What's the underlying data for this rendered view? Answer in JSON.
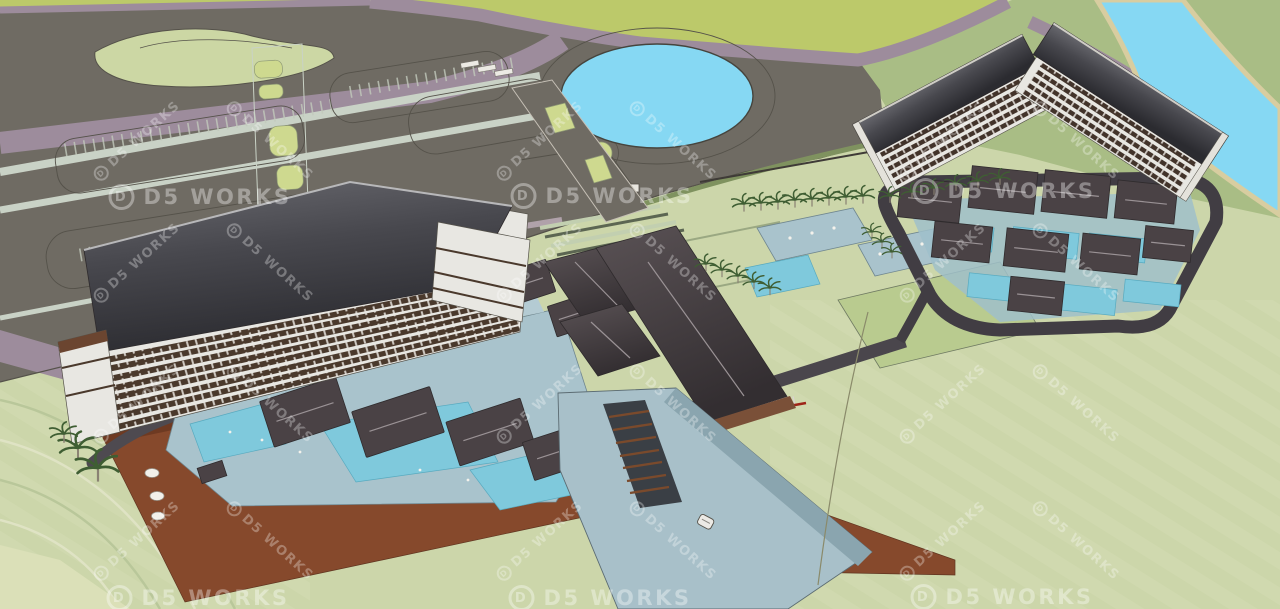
{
  "scene": {
    "title": "Aerial 3D massing render of a beachfront resort",
    "style": "sketchup-model-render",
    "features": [
      "parking lots",
      "circular pond",
      "left hotel slab",
      "right hotel L-block",
      "villa clusters with pools",
      "central clubhouse",
      "garden pools with palms",
      "river",
      "beach boardwalk",
      "pier deck with stairs",
      "roundabout"
    ]
  },
  "watermark": {
    "text": "D5 WORKS",
    "logo_letter": "D",
    "horizontal": [
      {
        "x": 200,
        "y": 197
      },
      {
        "x": 602,
        "y": 196
      },
      {
        "x": 1004,
        "y": 191
      },
      {
        "x": 198,
        "y": 598
      },
      {
        "x": 600,
        "y": 598
      },
      {
        "x": 1002,
        "y": 597
      }
    ],
    "diagonal": [
      {
        "x": 137,
        "y": 141,
        "dir": "up"
      },
      {
        "x": 270,
        "y": 141,
        "dir": "down"
      },
      {
        "x": 540,
        "y": 141,
        "dir": "up"
      },
      {
        "x": 673,
        "y": 141,
        "dir": "down"
      },
      {
        "x": 943,
        "y": 141,
        "dir": "up"
      },
      {
        "x": 1076,
        "y": 141,
        "dir": "down"
      },
      {
        "x": 137,
        "y": 263,
        "dir": "up"
      },
      {
        "x": 270,
        "y": 263,
        "dir": "down"
      },
      {
        "x": 540,
        "y": 263,
        "dir": "up"
      },
      {
        "x": 673,
        "y": 263,
        "dir": "down"
      },
      {
        "x": 943,
        "y": 263,
        "dir": "up"
      },
      {
        "x": 1076,
        "y": 263,
        "dir": "down"
      },
      {
        "x": 137,
        "y": 404,
        "dir": "up"
      },
      {
        "x": 270,
        "y": 404,
        "dir": "down"
      },
      {
        "x": 540,
        "y": 404,
        "dir": "up"
      },
      {
        "x": 673,
        "y": 404,
        "dir": "down"
      },
      {
        "x": 943,
        "y": 404,
        "dir": "up"
      },
      {
        "x": 1076,
        "y": 404,
        "dir": "down"
      },
      {
        "x": 137,
        "y": 541,
        "dir": "up"
      },
      {
        "x": 270,
        "y": 541,
        "dir": "down"
      },
      {
        "x": 540,
        "y": 541,
        "dir": "up"
      },
      {
        "x": 673,
        "y": 541,
        "dir": "down"
      },
      {
        "x": 943,
        "y": 541,
        "dir": "up"
      },
      {
        "x": 1076,
        "y": 541,
        "dir": "down"
      }
    ]
  },
  "colors": {
    "lawnPale": "#ccd6aa",
    "lawnBright": "#bcc96a",
    "lawnSage": "#a9bd85",
    "lawnBlob": "#ccd7a4",
    "lawnSlope": "#b9cb8f",
    "island": "#ced98f",
    "asphalt": "#6f6b63",
    "road": "#9d8c9c",
    "pathLight": "#c9d2c6",
    "outline": "#55524a",
    "water": "#86d8f3",
    "sand": "#d8cda0",
    "floorWhite": "#e8e7e2",
    "windowBrown": "#4a392c",
    "villaRoof": "#4a4245",
    "ridge": "#9a9295",
    "deckBlue": "#a9c3cc",
    "poolTeal": "#7fc9dc",
    "pier": "#a8c0c9",
    "pierSide": "#8aa5af",
    "promenade": "#4a464c",
    "accentRed": "#9e2418",
    "ringRoad": "#413d43",
    "wall": "#4e4a50",
    "boardwalk": "#86492c",
    "boardwalkDark": "#6e3a22",
    "palm": "#3f5e33",
    "trunk": "#8a8273",
    "stepBrown": "#7a4a2c"
  }
}
